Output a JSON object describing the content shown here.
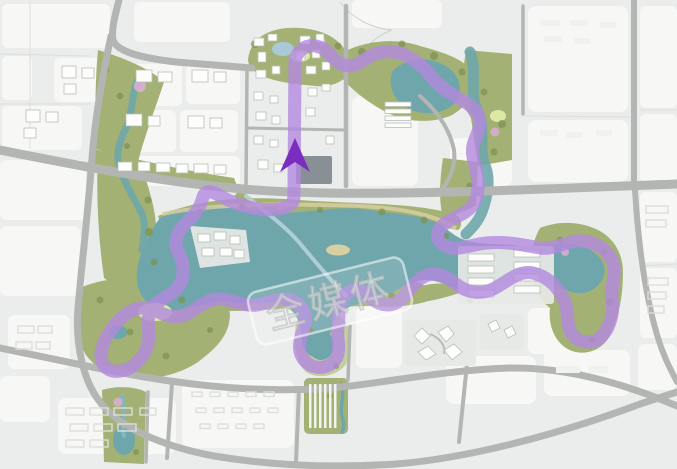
{
  "map": {
    "watermark_text": "全媒体",
    "description": "master-plan-map-with-lake-loop-route",
    "colors": {
      "bg": "#ebedec",
      "block": "#f7f8f6",
      "block_seam": "#dcdedb",
      "road": "#b3b5b2",
      "road_light": "#cfd1ce",
      "park": "#a3b274",
      "park_dark": "#7d9154",
      "park_light": "#c3cf9c",
      "lawn": "#dde8a4",
      "water": "#6fa6ab",
      "stream": "#85b6ba",
      "shore": "#d8cfa2",
      "route": "#7b2dbe",
      "route_glow": "#b48ae0",
      "route_core": "#9d68d8",
      "pink": "#dcaed6",
      "building": "#fdfdfb",
      "building_stroke": "#b9bdb9",
      "pad": "#e6e9e5",
      "dark_building": "#717880",
      "watermark": "#ffffff"
    }
  }
}
